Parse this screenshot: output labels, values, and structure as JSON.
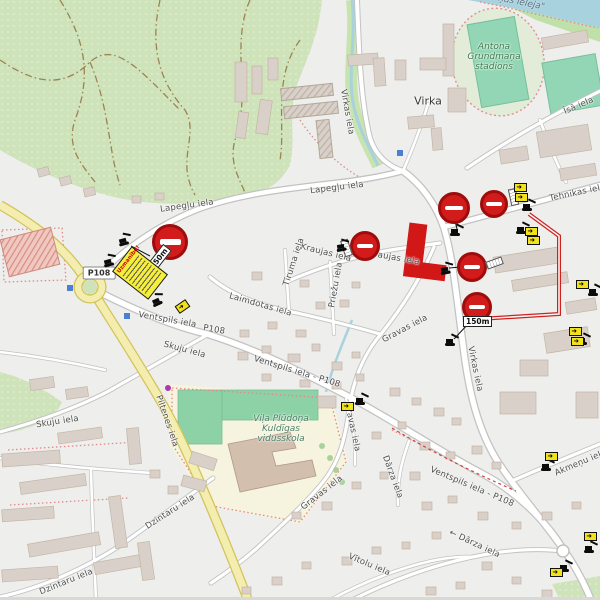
{
  "map": {
    "place": {
      "virka": "Virka"
    },
    "areas": {
      "stadium_line1": "Antona",
      "stadium_line2": "Grundmaņa",
      "stadium_line3": "stadions",
      "school_line1": "Viļa Plūdoņa",
      "school_line2": "Kuldīgas",
      "school_line3": "vidusskola",
      "valley_label": "ņas ieleja\""
    },
    "ref_badge": "P108",
    "warning_sign": {
      "title": "Uzmanību!"
    },
    "distance_badges": [
      {
        "text": "450m"
      },
      {
        "text": "150m"
      }
    ],
    "streets": [
      {
        "label": "Lapegļu iela"
      },
      {
        "label": "Lapegļu iela"
      },
      {
        "label": "Virkas iela"
      },
      {
        "label": "Virkas iela"
      },
      {
        "label": "Tehnikas iela"
      },
      {
        "label": "Īsā iela"
      },
      {
        "label": "Kraujas iela"
      },
      {
        "label": "Kraujas iela"
      },
      {
        "label": "Tīruma iela"
      },
      {
        "label": "Priežu iela"
      },
      {
        "label": "Laimdotas iela"
      },
      {
        "label": "Ventspils iela"
      },
      {
        "label": "P108"
      },
      {
        "label": "Ventspils iela - P108"
      },
      {
        "label": "Ventspils iela - P108"
      },
      {
        "label": "Skuju iela"
      },
      {
        "label": "Skuju iela"
      },
      {
        "label": "Dzintaru iela"
      },
      {
        "label": "Dzintaru iela"
      },
      {
        "label": "Gravas iela"
      },
      {
        "label": "Gravas iela"
      },
      {
        "label": "Gravas iela"
      },
      {
        "label": "Dārza iela"
      },
      {
        "label": "← Dārza iela"
      },
      {
        "label": "Vītolu iela"
      },
      {
        "label": "Akmeņu iela"
      },
      {
        "label": "Piltenes iela"
      }
    ]
  }
}
